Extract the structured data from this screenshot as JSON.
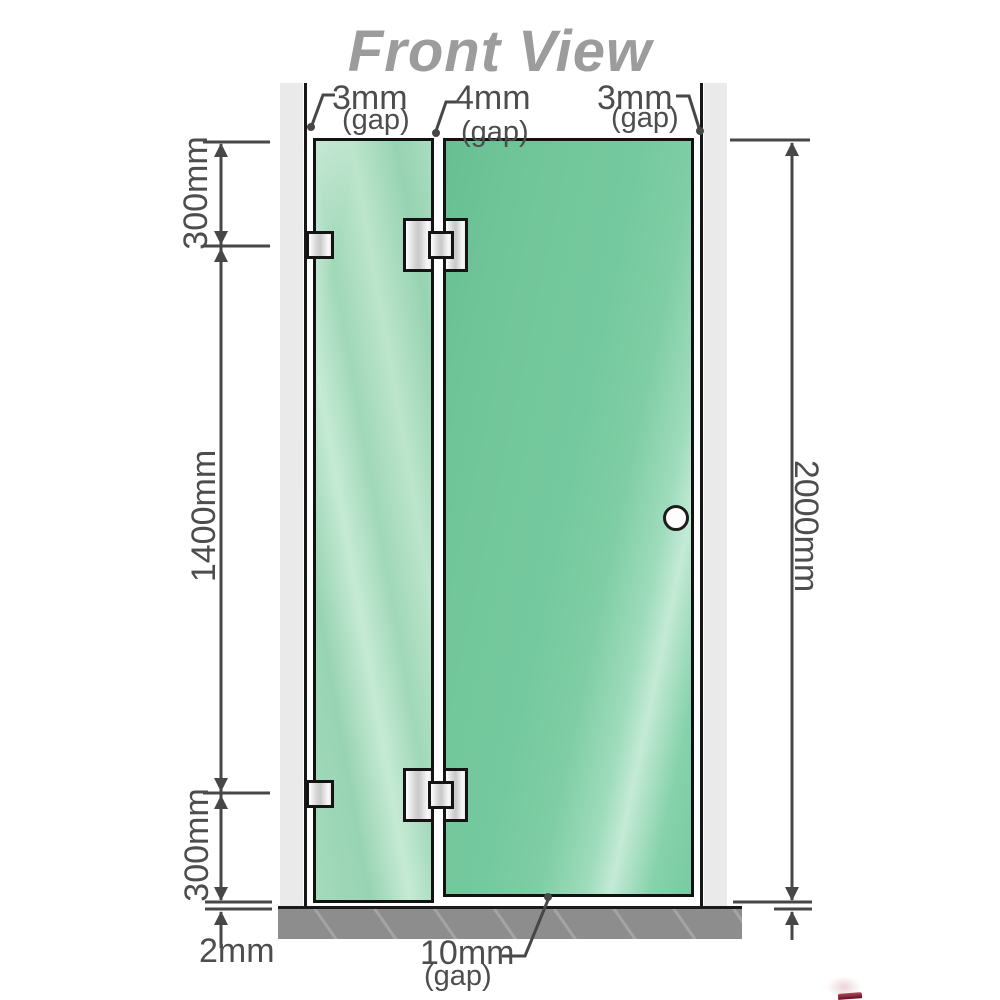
{
  "title": "Front View",
  "annotations": {
    "gap_left": {
      "value": "3mm",
      "sub": "(gap)"
    },
    "gap_middle": {
      "value": "4mm",
      "sub": "(gap)"
    },
    "gap_right": {
      "value": "3mm",
      "sub": "(gap)"
    },
    "height_top": "300mm",
    "height_middle": "1400mm",
    "height_bottom": "300mm",
    "height_total": "2000mm",
    "floor_gap_panel": "2mm",
    "floor_gap_door": {
      "value": "10mm",
      "sub": "(gap)"
    }
  },
  "diagram": {
    "type": "shower-screen-front-elevation",
    "panels": [
      {
        "name": "fixed-glass-panel",
        "hardware": [
          "wall-bracket-top",
          "wall-bracket-bottom"
        ]
      },
      {
        "name": "glass-door-panel",
        "hardware": [
          "glass-hinge-top",
          "glass-hinge-bottom",
          "door-handle"
        ]
      }
    ],
    "gaps_mm": {
      "left_wall_to_panel": 3,
      "between_panels": 4,
      "door_to_right_wall": 3,
      "under_fixed_panel": 2,
      "under_door": 10
    },
    "heights_mm": {
      "top_section": 300,
      "middle_section": 1400,
      "bottom_section": 300,
      "total": 2000
    }
  },
  "colors": {
    "glass": "#8bd1aa",
    "glass_highlight": "#c6ead4",
    "door_glass": "#74c89c",
    "wall": "#eaeaea",
    "floor": "#8d8d8d",
    "outline": "#121212",
    "dimension_lines": "#474747",
    "label_text": "#4d4d4d",
    "title_text": "#9c9c9c"
  }
}
